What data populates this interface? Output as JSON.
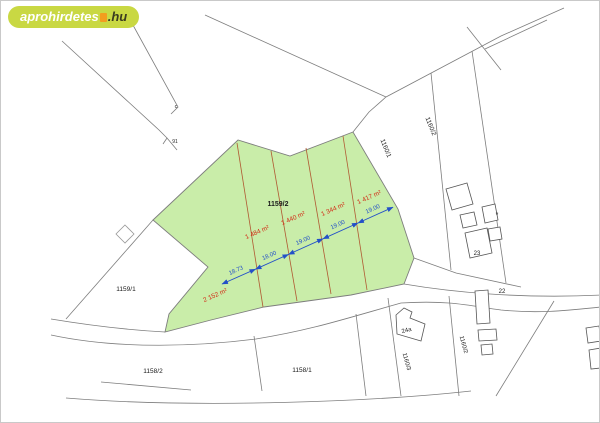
{
  "watermark": {
    "brand": "aprohirdetes",
    "tld": ".hu",
    "badge_color": "#c9d843",
    "brand_color": "#ffffff",
    "accent_color": "#f29d1e",
    "tld_color": "#3b3b20"
  },
  "map": {
    "highlighted_plot": "1159/2",
    "colors": {
      "highlight_fill": "#c9eda9",
      "parcel_line": "#7d7d7d",
      "subdivision_line": "#b05a33",
      "dimension_blue": "#2350c8",
      "area_label_red": "#d22c17",
      "label_black": "#1a1a1a",
      "building_line": "#555555"
    },
    "parcel_labels": [
      {
        "text": "1159/2",
        "x": 277,
        "y": 205,
        "rot": 0,
        "bold": true,
        "size": 7
      },
      {
        "text": "1159/1",
        "x": 125,
        "y": 290,
        "rot": 0,
        "size": 6.5
      },
      {
        "text": "1158/2",
        "x": 152,
        "y": 372,
        "rot": 0,
        "size": 6.5
      },
      {
        "text": "1158/1",
        "x": 301,
        "y": 371,
        "rot": 0,
        "size": 6.5
      },
      {
        "text": "1160/1",
        "x": 383,
        "y": 148,
        "rot": 68,
        "size": 6.5
      },
      {
        "text": "1160/2",
        "x": 428,
        "y": 126,
        "rot": 68,
        "size": 6.5
      },
      {
        "text": "1160/3",
        "x": 404,
        "y": 361,
        "rot": 75,
        "size": 6
      },
      {
        "text": "1160/2",
        "x": 461,
        "y": 344,
        "rot": 75,
        "size": 6
      },
      {
        "text": "23",
        "x": 476,
        "y": 254,
        "rot": 0,
        "size": 6
      },
      {
        "text": "22",
        "x": 501,
        "y": 292,
        "rot": 0,
        "size": 6
      },
      {
        "text": "24a",
        "x": 406,
        "y": 331,
        "rot": -15,
        "size": 6
      },
      {
        "text": "c",
        "x": 175,
        "y": 107,
        "rot": 0,
        "size": 5.5
      },
      {
        "text": "91",
        "x": 174,
        "y": 142,
        "rot": 0,
        "size": 5
      },
      {
        "text": "*",
        "x": 496,
        "y": 216,
        "rot": 0,
        "size": 7
      }
    ],
    "area_labels": [
      {
        "text": "2 152 m²",
        "x": 215,
        "y": 296,
        "rot": -24
      },
      {
        "text": "1 484 m²",
        "x": 257,
        "y": 233,
        "rot": -24
      },
      {
        "text": "1 440 m²",
        "x": 293,
        "y": 219,
        "rot": -24
      },
      {
        "text": "1 344 m²",
        "x": 333,
        "y": 210,
        "rot": -24
      },
      {
        "text": "1 417 m²",
        "x": 369,
        "y": 198,
        "rot": -24
      }
    ],
    "dimension": {
      "segments": [
        {
          "label": "18.73",
          "x1": 221,
          "y1": 283,
          "x2": 254.5,
          "y2": 268.2
        },
        {
          "label": "18.00",
          "x1": 254.5,
          "y1": 268.2,
          "x2": 287.5,
          "y2": 253.4
        },
        {
          "label": "19.00",
          "x1": 287.5,
          "y1": 253.4,
          "x2": 322,
          "y2": 237.8
        },
        {
          "label": "19.00",
          "x1": 322,
          "y1": 237.8,
          "x2": 357,
          "y2": 222.0
        },
        {
          "label": "19.00",
          "x1": 357,
          "y1": 222.0,
          "x2": 392,
          "y2": 206.2
        }
      ]
    }
  }
}
